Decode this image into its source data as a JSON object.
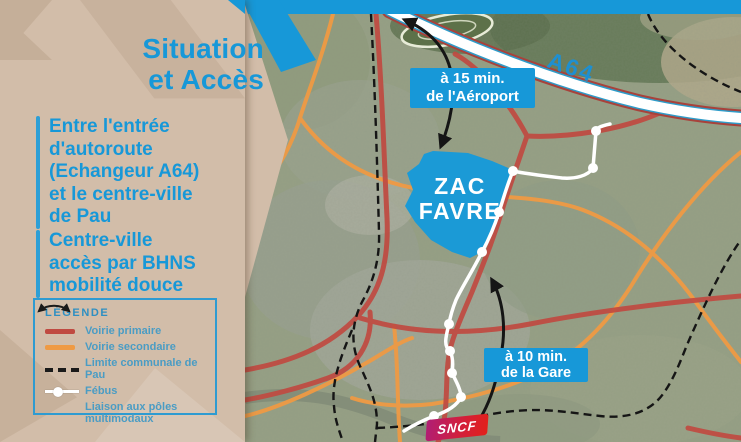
{
  "slide": {
    "title": "Situation\net Accès",
    "bullets": [
      "Entre l'entrée\nd'autoroute\n(Echangeur A64)\net le centre-ville\nde Pau",
      "Centre-ville\naccès par BHNS\nmobilité douce"
    ]
  },
  "legend": {
    "title": "LÉGENDE",
    "items": [
      {
        "icon": "primary-road-line",
        "label": "Voirie primaire"
      },
      {
        "icon": "secondary-road-line",
        "label": "Voirie secondaire"
      },
      {
        "icon": "commune-boundary-dashes",
        "label": "Limite communale de Pau"
      },
      {
        "icon": "febus-line-dot",
        "label": "Fébus"
      },
      {
        "icon": "multimodal-arrow",
        "label": "Liaison aux pôles\nmultimodaux"
      }
    ]
  },
  "map": {
    "highway_label": "A64",
    "zone_label": "ZAC\nFAVRE",
    "badges": {
      "airport": "à 15 min.\nde l'Aéroport",
      "station": "à 10 min.\nde la Gare"
    },
    "sncf_logo": "SNCF"
  },
  "colors": {
    "accent_blue": "#1798d8",
    "panel_beige": "#d2bda9",
    "road_primary": "#c04a41",
    "road_secondary": "#ef9a44",
    "boundary_black": "#151515",
    "febus_white": "#ffffff",
    "zone_blue": "#1b9ad6",
    "sncf_magenta": "#b01e75",
    "sncf_red": "#e2201a"
  }
}
